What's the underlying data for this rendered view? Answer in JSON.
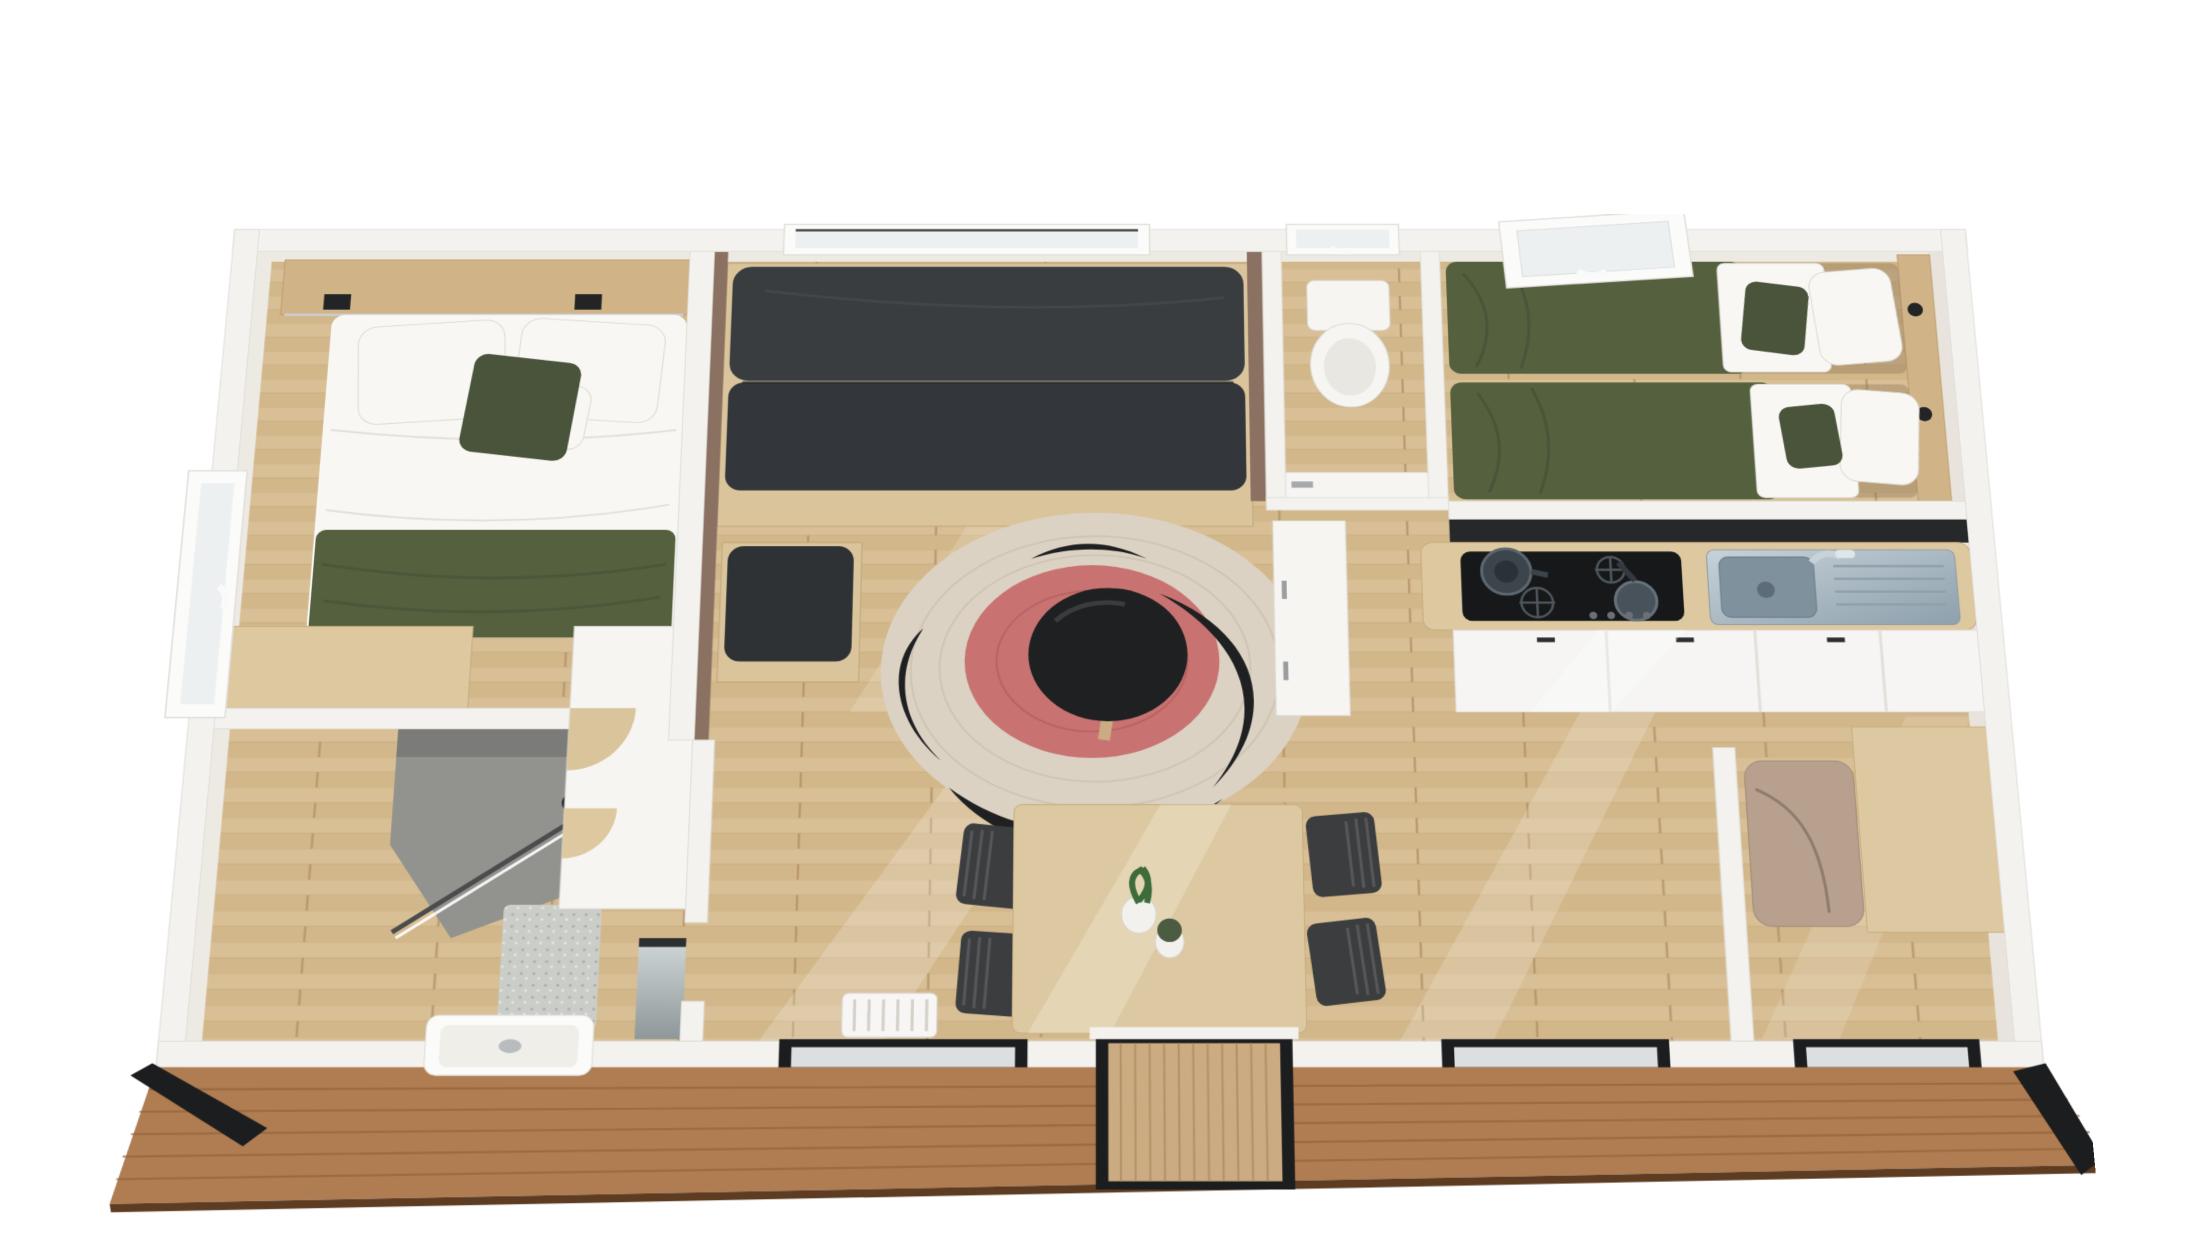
{
  "palette": {
    "background": "#ffffff",
    "wall_cut": "#f3f2ef",
    "accent_wall_brown": "#8b7162",
    "floor_wood": "#d6bc92",
    "headboard_wood": "#d0b488",
    "counter_wood": "#ddc8a0",
    "furniture_wood": "#d9c49c",
    "table_wood": "#ddc9a1",
    "sofa_dark": "#3a3d40",
    "seat_dark": "#33363a",
    "ottoman_dark": "#2f3234",
    "bedding_green": "#55603f",
    "bedding_green_dark": "#49543a",
    "linen_white": "#f8f7f4",
    "rug_outer": "#dbd2c3",
    "rug_red": "#c97272",
    "rug_black": "#1f2022",
    "backsplash_black": "#26282a",
    "hob_black": "#17181a",
    "steel": "#aab6bf",
    "steel_dark": "#7f919d",
    "shower_tile": "#92938f",
    "shower_tile_dark": "#7b7c79",
    "mat_gray": "#cbcdc9",
    "mirror_gray": "#b9c0c2",
    "cladding_wood": "#b07c51",
    "cladding_edge": "#5d3c22",
    "frame_black": "#1c1d1e",
    "door_wood": "#cbab81",
    "fridge_taupe": "#b7a08d",
    "glass": "#edf0f1",
    "chair_dark": "#3b3d3f",
    "plant_green": "#3e6b3a",
    "toilet_white": "#f6f5f2",
    "radiator_white": "#f7f6f4"
  }
}
